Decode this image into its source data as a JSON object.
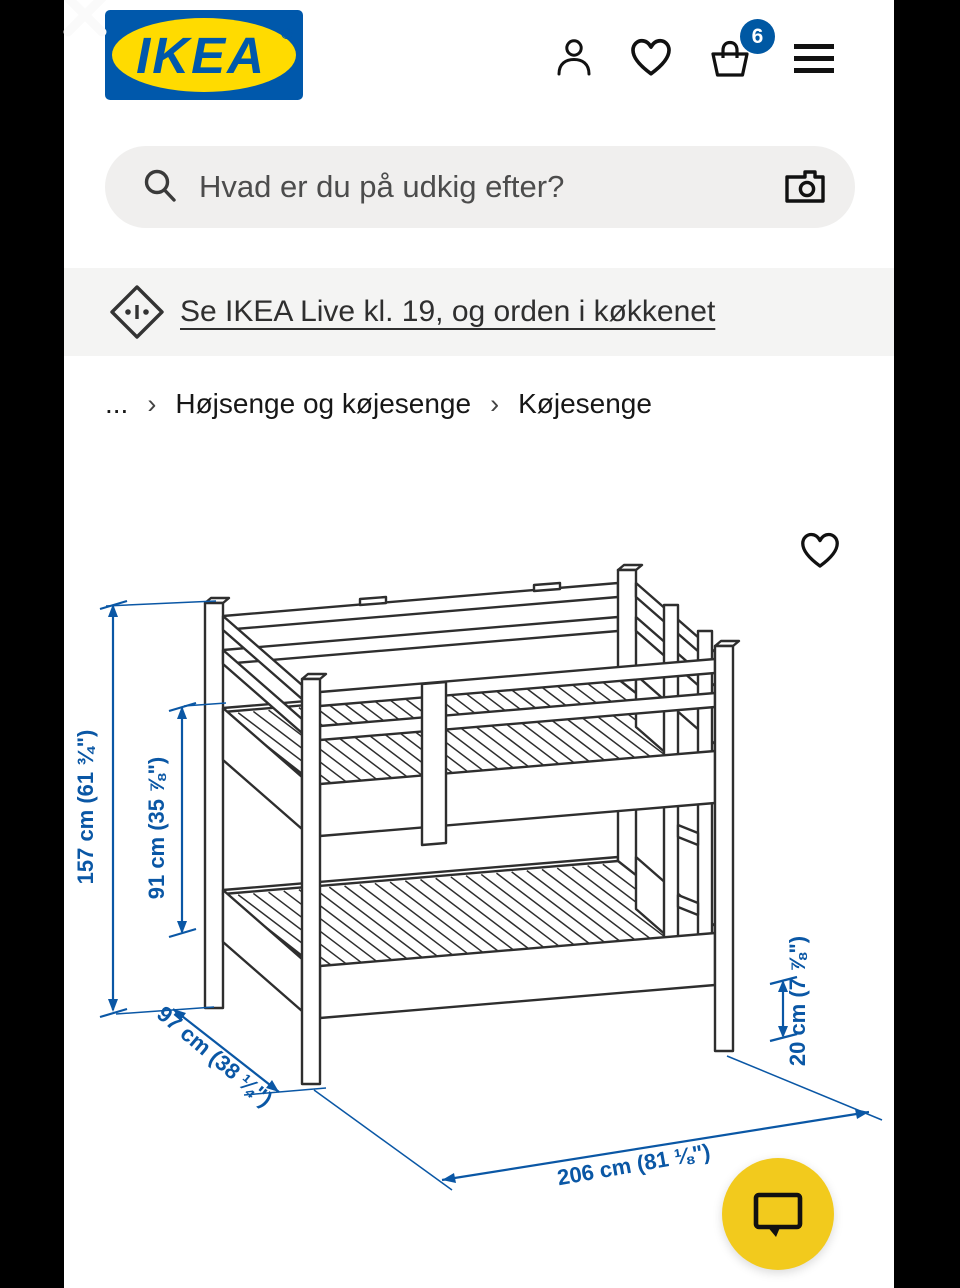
{
  "theme": {
    "brand_blue": "#0058A3",
    "brand_yellow": "#FFDB00",
    "dimension_blue": "#0A57A5",
    "fab_yellow": "#F2CA1D"
  },
  "header": {
    "logo_text": "IKEA",
    "registered_mark": "®",
    "cart_badge_count": "6"
  },
  "search": {
    "placeholder": "Hvad er du på udkig efter?"
  },
  "promo_banner": {
    "link_text": "Se IKEA Live kl. 19, og orden i køkkenet"
  },
  "breadcrumb": {
    "ellipsis": "...",
    "separator": "›",
    "items": [
      "Højsenge og køjesenge",
      "Køjesenge"
    ]
  },
  "figure": {
    "product_category": "Køjesenge",
    "dimensions": {
      "total_height": "157 cm (61 ¾\")",
      "inner_height": "91 cm (35 ⅞\")",
      "width": "97 cm (38 ¼\")",
      "lower_bed_height": "20 cm (7 ⅞\")",
      "length": "206 cm (81 ⅛\")"
    }
  }
}
